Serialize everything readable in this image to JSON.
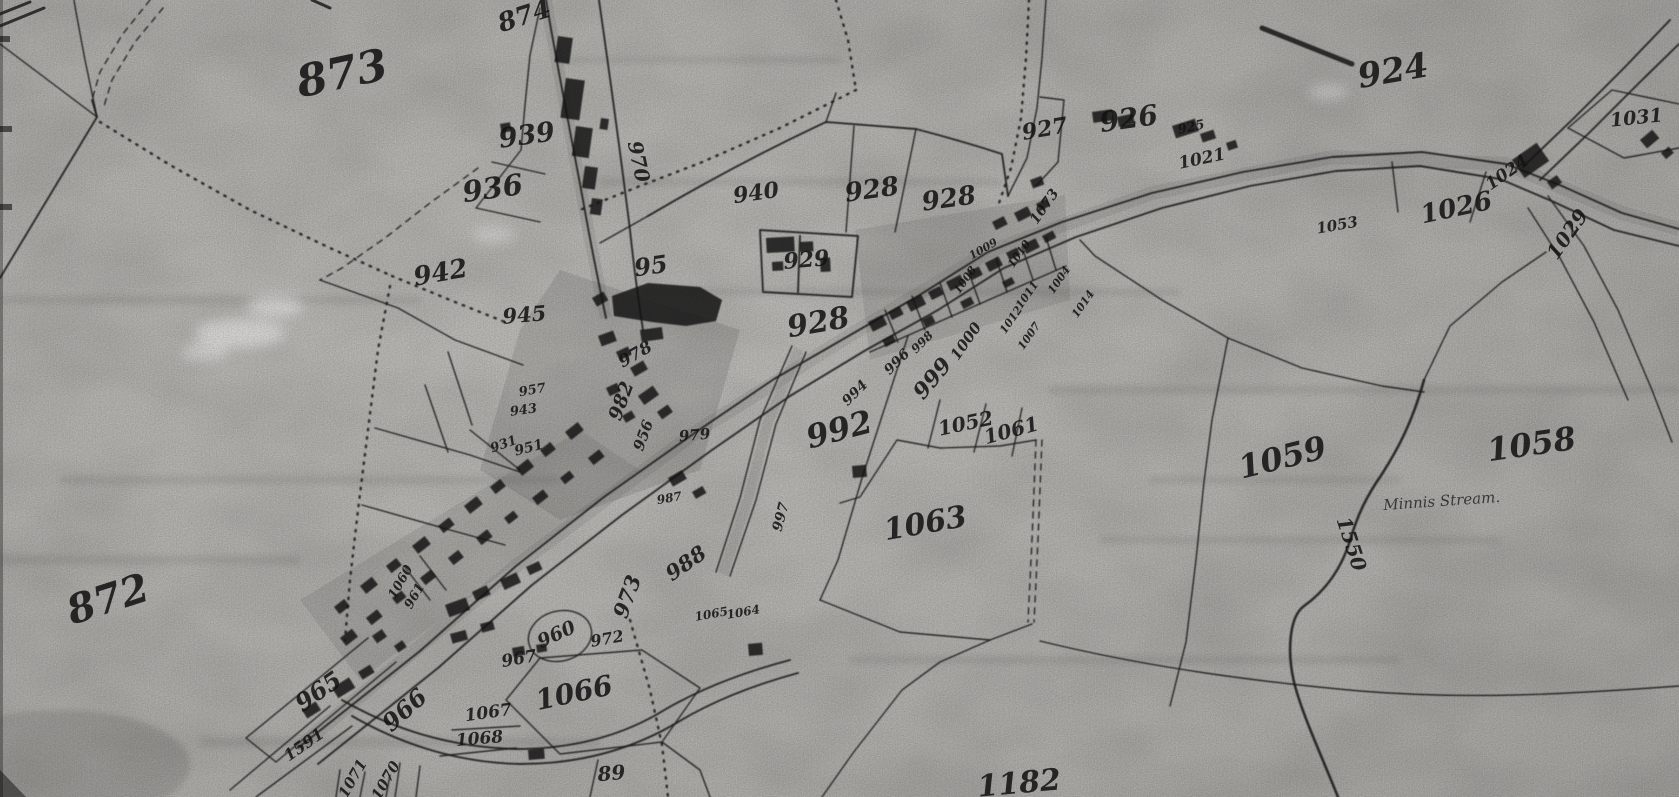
{
  "map": {
    "type": "historical-cadastral-map-scan",
    "paper_color": "#b6b4b0",
    "ink_color": "#1b1b1b",
    "stream_annotation": "Minnis Stream.",
    "parcel_labels": [
      {
        "text": "873",
        "x": 345,
        "y": 88,
        "size": 44,
        "rot": -12
      },
      {
        "text": "874",
        "x": 527,
        "y": 24,
        "size": 26,
        "rot": -18
      },
      {
        "text": "939",
        "x": 528,
        "y": 144,
        "size": 27,
        "rot": -8
      },
      {
        "text": "936",
        "x": 494,
        "y": 198,
        "size": 29,
        "rot": -8
      },
      {
        "text": "970",
        "x": 632,
        "y": 163,
        "size": 20,
        "rot": 78
      },
      {
        "text": "942",
        "x": 442,
        "y": 281,
        "size": 26,
        "rot": -10
      },
      {
        "text": "945",
        "x": 525,
        "y": 322,
        "size": 21,
        "rot": -5
      },
      {
        "text": "978",
        "x": 638,
        "y": 359,
        "size": 17,
        "rot": -30
      },
      {
        "text": "95",
        "x": 652,
        "y": 274,
        "size": 24,
        "rot": -8
      },
      {
        "text": "940",
        "x": 757,
        "y": 200,
        "size": 22,
        "rot": -8
      },
      {
        "text": "928",
        "x": 873,
        "y": 198,
        "size": 26,
        "rot": -8
      },
      {
        "text": "928",
        "x": 950,
        "y": 207,
        "size": 26,
        "rot": -8
      },
      {
        "text": "929",
        "x": 807,
        "y": 267,
        "size": 22,
        "rot": -5
      },
      {
        "text": "928",
        "x": 820,
        "y": 332,
        "size": 30,
        "rot": -10
      },
      {
        "text": "927",
        "x": 1046,
        "y": 136,
        "size": 22,
        "rot": -10
      },
      {
        "text": "925",
        "x": 1192,
        "y": 131,
        "size": 13,
        "rot": -12
      },
      {
        "text": "926",
        "x": 1130,
        "y": 128,
        "size": 28,
        "rot": -8
      },
      {
        "text": "1021",
        "x": 1203,
        "y": 164,
        "size": 17,
        "rot": -12
      },
      {
        "text": "924",
        "x": 1395,
        "y": 82,
        "size": 34,
        "rot": -10
      },
      {
        "text": "1031",
        "x": 1637,
        "y": 124,
        "size": 19,
        "rot": -6
      },
      {
        "text": "1026",
        "x": 1458,
        "y": 216,
        "size": 26,
        "rot": -12
      },
      {
        "text": "1029",
        "x": 1573,
        "y": 238,
        "size": 20,
        "rot": -55
      },
      {
        "text": "1024",
        "x": 1510,
        "y": 177,
        "size": 17,
        "rot": -35
      },
      {
        "text": "1053",
        "x": 1338,
        "y": 230,
        "size": 15,
        "rot": -10
      },
      {
        "text": "1073",
        "x": 1048,
        "y": 209,
        "size": 14,
        "rot": -55
      },
      {
        "text": "957",
        "x": 533,
        "y": 394,
        "size": 13,
        "rot": -10
      },
      {
        "text": "943",
        "x": 524,
        "y": 414,
        "size": 13,
        "rot": -8
      },
      {
        "text": "951",
        "x": 530,
        "y": 452,
        "size": 14,
        "rot": -15
      },
      {
        "text": "931",
        "x": 505,
        "y": 448,
        "size": 13,
        "rot": -20
      },
      {
        "text": "982",
        "x": 627,
        "y": 403,
        "size": 19,
        "rot": -70
      },
      {
        "text": "956",
        "x": 648,
        "y": 437,
        "size": 15,
        "rot": -70
      },
      {
        "text": "979",
        "x": 695,
        "y": 440,
        "size": 15,
        "rot": -5
      },
      {
        "text": "992",
        "x": 842,
        "y": 440,
        "size": 32,
        "rot": -15
      },
      {
        "text": "994",
        "x": 858,
        "y": 396,
        "size": 14,
        "rot": -45
      },
      {
        "text": "996",
        "x": 900,
        "y": 365,
        "size": 14,
        "rot": -45
      },
      {
        "text": "998",
        "x": 925,
        "y": 345,
        "size": 12,
        "rot": -45
      },
      {
        "text": "999",
        "x": 938,
        "y": 383,
        "size": 22,
        "rot": -50
      },
      {
        "text": "1000",
        "x": 970,
        "y": 344,
        "size": 15,
        "rot": -55
      },
      {
        "text": "1052",
        "x": 967,
        "y": 430,
        "size": 20,
        "rot": -12
      },
      {
        "text": "1061",
        "x": 1013,
        "y": 437,
        "size": 20,
        "rot": -15
      },
      {
        "text": "1063",
        "x": 927,
        "y": 533,
        "size": 30,
        "rot": -10
      },
      {
        "text": "1059",
        "x": 1285,
        "y": 468,
        "size": 32,
        "rot": -14
      },
      {
        "text": "1058",
        "x": 1533,
        "y": 455,
        "size": 32,
        "rot": -8
      },
      {
        "text": "1550",
        "x": 1345,
        "y": 546,
        "size": 20,
        "rot": 72
      },
      {
        "text": "Minnis Stream.",
        "x": 1442,
        "y": 506,
        "size": 15,
        "rot": -4,
        "cls": "lbl-cursive"
      },
      {
        "text": "872",
        "x": 112,
        "y": 612,
        "size": 40,
        "rot": -18
      },
      {
        "text": "965",
        "x": 323,
        "y": 698,
        "size": 24,
        "rot": -35
      },
      {
        "text": "966",
        "x": 410,
        "y": 716,
        "size": 24,
        "rot": -42
      },
      {
        "text": "1591",
        "x": 307,
        "y": 749,
        "size": 16,
        "rot": -35
      },
      {
        "text": "1071",
        "x": 357,
        "y": 781,
        "size": 15,
        "rot": -60
      },
      {
        "text": "1070",
        "x": 390,
        "y": 783,
        "size": 15,
        "rot": -60
      },
      {
        "text": "1060",
        "x": 404,
        "y": 584,
        "size": 13,
        "rot": -60
      },
      {
        "text": "961",
        "x": 418,
        "y": 598,
        "size": 13,
        "rot": -60
      },
      {
        "text": "967",
        "x": 520,
        "y": 664,
        "size": 17,
        "rot": -10
      },
      {
        "text": "1067",
        "x": 489,
        "y": 718,
        "size": 17,
        "rot": -8
      },
      {
        "text": "1068",
        "x": 480,
        "y": 744,
        "size": 17,
        "rot": -5
      },
      {
        "text": "1066",
        "x": 576,
        "y": 702,
        "size": 28,
        "rot": -12
      },
      {
        "text": "960",
        "x": 559,
        "y": 640,
        "size": 19,
        "rot": -25
      },
      {
        "text": "973",
        "x": 634,
        "y": 599,
        "size": 21,
        "rot": -70
      },
      {
        "text": "972",
        "x": 608,
        "y": 644,
        "size": 16,
        "rot": -10
      },
      {
        "text": "988",
        "x": 690,
        "y": 569,
        "size": 21,
        "rot": -35
      },
      {
        "text": "987",
        "x": 670,
        "y": 502,
        "size": 12,
        "rot": -10
      },
      {
        "text": "997",
        "x": 785,
        "y": 518,
        "size": 14,
        "rot": -75
      },
      {
        "text": "1065",
        "x": 712,
        "y": 618,
        "size": 12,
        "rot": -10
      },
      {
        "text": "1064",
        "x": 744,
        "y": 616,
        "size": 12,
        "rot": -10
      },
      {
        "text": "89",
        "x": 612,
        "y": 780,
        "size": 20,
        "rot": -5
      },
      {
        "text": "1182",
        "x": 1020,
        "y": 793,
        "size": 30,
        "rot": -5
      },
      {
        "text": "1009",
        "x": 985,
        "y": 252,
        "size": 11,
        "rot": -30
      },
      {
        "text": "1008",
        "x": 968,
        "y": 282,
        "size": 11,
        "rot": -55
      },
      {
        "text": "1010",
        "x": 1022,
        "y": 256,
        "size": 11,
        "rot": -55
      },
      {
        "text": "1011",
        "x": 1030,
        "y": 297,
        "size": 11,
        "rot": -55
      },
      {
        "text": "1012",
        "x": 1014,
        "y": 322,
        "size": 11,
        "rot": -55
      },
      {
        "text": "1007",
        "x": 1032,
        "y": 338,
        "size": 11,
        "rot": -55
      },
      {
        "text": "1014",
        "x": 1086,
        "y": 306,
        "size": 11,
        "rot": -55
      },
      {
        "text": "1004",
        "x": 1062,
        "y": 282,
        "size": 11,
        "rot": -55
      }
    ]
  }
}
